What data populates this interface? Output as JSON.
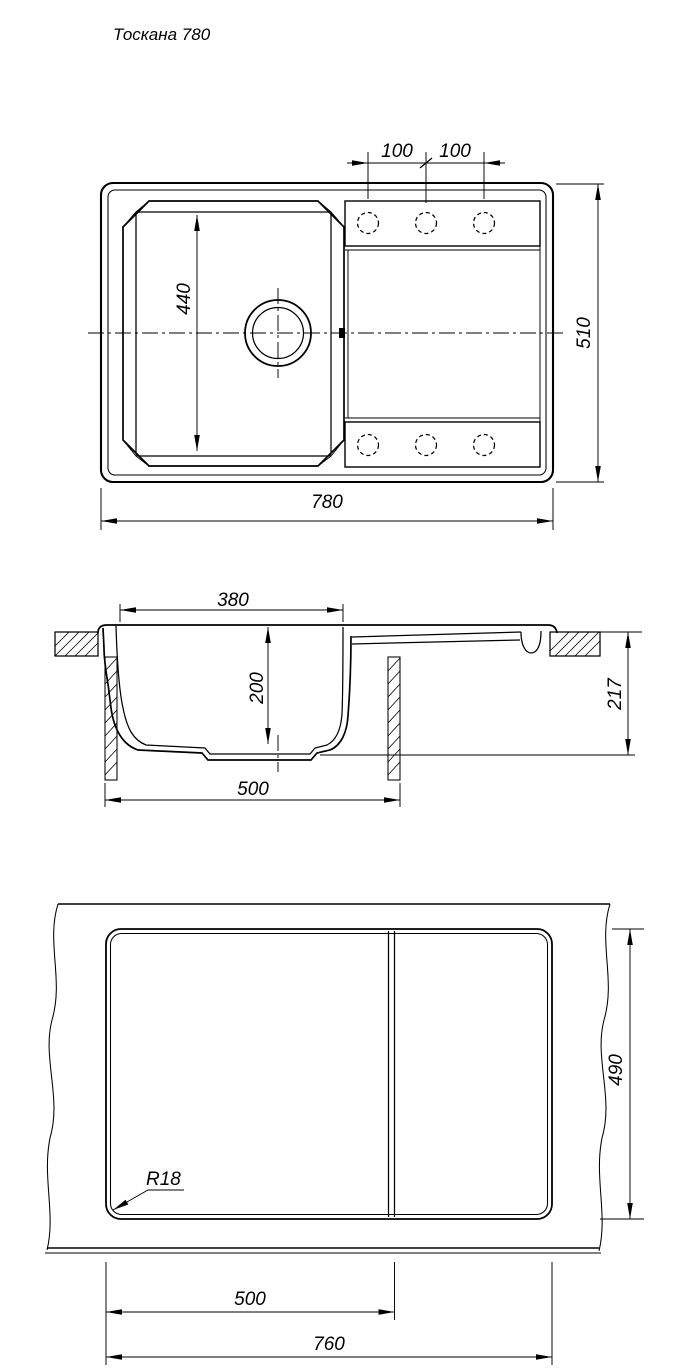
{
  "colors": {
    "ink": "#000000",
    "paper": "#ffffff"
  },
  "title": "Тоскана 780",
  "top_view": {
    "dim_hole_pitch_1": "100",
    "dim_hole_pitch_2": "100",
    "dim_bowl_width": "440",
    "dim_overall_depth": "510",
    "dim_overall_length": "780"
  },
  "section_view": {
    "dim_bowl_top_width": "380",
    "dim_bowl_depth": "200",
    "dim_base_width": "500",
    "dim_total_height": "217"
  },
  "cutout_view": {
    "radius_label": "R18",
    "dim_cutout_depth": "490",
    "dim_bowl_cutout_width": "500",
    "dim_cutout_length": "760"
  }
}
